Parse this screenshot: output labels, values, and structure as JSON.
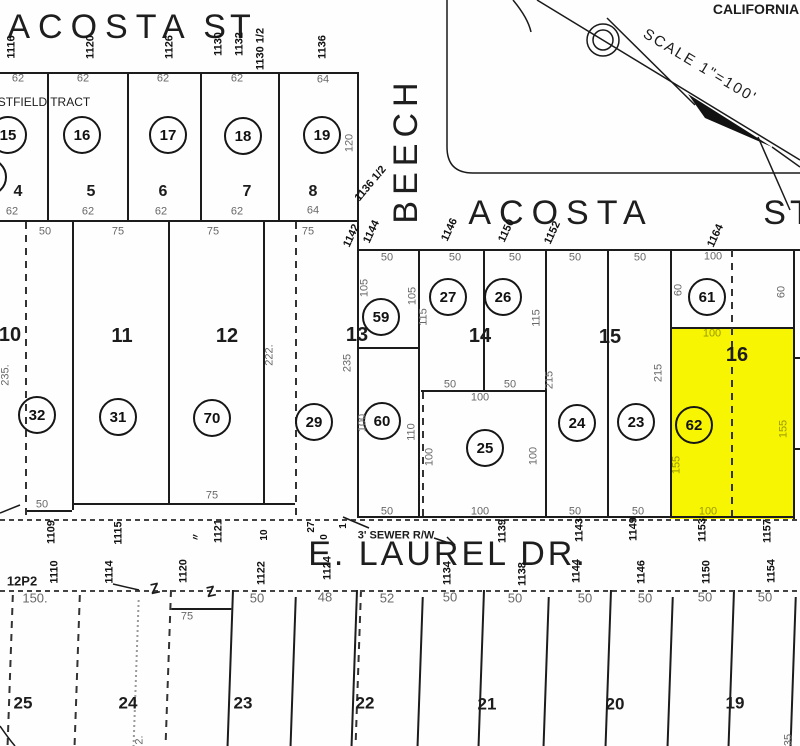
{
  "map": {
    "region_text": "CALIFORNIA",
    "scale_label": "SCALE 1\"=100'",
    "tract_label": "STFIELD TRACT",
    "streets": [
      "ACOSTA ST",
      "BEECH",
      "ACOSTA ST",
      "E. LAUREL DR."
    ],
    "sewer_note": "3' SEWER R/W",
    "sheet_ref": "12P2",
    "highlight": {
      "parcel": "62",
      "block": "16",
      "color": "#f7f501",
      "dim_color": "#9a9a00"
    }
  },
  "labels": {
    "streets": [
      {
        "t": "ACOSTA",
        "x": 100,
        "y": 27,
        "ls": 8
      },
      {
        "t": "ST",
        "x": 229,
        "y": 27,
        "ls": 4
      },
      {
        "t": "BEECH",
        "x": 406,
        "y": 150,
        "ls": 6,
        "r": -90
      },
      {
        "t": "ACOSTA",
        "x": 561,
        "y": 213,
        "ls": 8
      },
      {
        "t": "ST",
        "x": 789,
        "y": 213,
        "ls": 4
      },
      {
        "t": "E. LAUREL DR.",
        "x": 448,
        "y": 554,
        "ls": 3
      }
    ],
    "annotations": [
      {
        "t": "CALIFORNIA",
        "x": 756,
        "y": 9,
        "s": 14,
        "w": 700
      },
      {
        "t": "SCALE 1\"=100'",
        "x": 700,
        "y": 66,
        "s": 15,
        "r": 31,
        "ls": 2
      },
      {
        "t": "STFIELD TRACT",
        "x": 44,
        "y": 102,
        "s": 12
      },
      {
        "t": "3' SEWER R/W",
        "x": 396,
        "y": 536,
        "s": 11,
        "w": 700
      },
      {
        "t": "12P2",
        "x": 22,
        "y": 581,
        "s": 13,
        "w": 700
      },
      {
        "t": "Z",
        "x": 155,
        "y": 589,
        "s": 15,
        "w": 700,
        "r": -12
      },
      {
        "t": "Z",
        "x": 211,
        "y": 592,
        "s": 15,
        "w": 700,
        "r": -12
      }
    ],
    "addresses": [
      {
        "t": "1116",
        "x": 12,
        "y": 47,
        "r": -90
      },
      {
        "t": "1120",
        "x": 91,
        "y": 47,
        "r": -90
      },
      {
        "t": "1126",
        "x": 170,
        "y": 47,
        "r": -90
      },
      {
        "t": "1130",
        "x": 219,
        "y": 44,
        "r": -90
      },
      {
        "t": "1132",
        "x": 240,
        "y": 44,
        "r": -90
      },
      {
        "t": "1130 1/2",
        "x": 261,
        "y": 49,
        "r": -90
      },
      {
        "t": "1136",
        "x": 323,
        "y": 47,
        "r": -90
      },
      {
        "t": "1136 1/2",
        "x": 371,
        "y": 184,
        "r": -50
      },
      {
        "t": "1142",
        "x": 352,
        "y": 236,
        "r": -65
      },
      {
        "t": "1144",
        "x": 372,
        "y": 232,
        "r": -65
      },
      {
        "t": "1146",
        "x": 450,
        "y": 230,
        "r": -65
      },
      {
        "t": "1150",
        "x": 507,
        "y": 231,
        "r": -65
      },
      {
        "t": "1152",
        "x": 553,
        "y": 233,
        "r": -65
      },
      {
        "t": "1164",
        "x": 716,
        "y": 236,
        "r": -65
      },
      {
        "t": "1109",
        "x": 52,
        "y": 532,
        "r": -90
      },
      {
        "t": "1115",
        "x": 119,
        "y": 533,
        "r": -90
      },
      {
        "t": "〃",
        "x": 196,
        "y": 537,
        "r": -90,
        "s": 9
      },
      {
        "t": "1121",
        "x": 219,
        "y": 531,
        "r": -90
      },
      {
        "t": "10",
        "x": 265,
        "y": 535,
        "r": -90,
        "s": 10
      },
      {
        "t": "27",
        "x": 312,
        "y": 527,
        "r": -90,
        "s": 10
      },
      {
        "t": "0",
        "x": 325,
        "y": 537,
        "r": -90,
        "s": 10
      },
      {
        "t": "1",
        "x": 344,
        "y": 526,
        "r": -90,
        "s": 10
      },
      {
        "t": "1139",
        "x": 503,
        "y": 531,
        "r": -90
      },
      {
        "t": "1143",
        "x": 580,
        "y": 530,
        "r": -90
      },
      {
        "t": "1149",
        "x": 634,
        "y": 529,
        "r": -90
      },
      {
        "t": "1153",
        "x": 703,
        "y": 530,
        "r": -90
      },
      {
        "t": "1157",
        "x": 768,
        "y": 531,
        "r": -90
      },
      {
        "t": "1110",
        "x": 55,
        "y": 572,
        "r": -90
      },
      {
        "t": "1114",
        "x": 110,
        "y": 572,
        "r": -90
      },
      {
        "t": "1120",
        "x": 184,
        "y": 571,
        "r": -90
      },
      {
        "t": "1122",
        "x": 262,
        "y": 573,
        "r": -90
      },
      {
        "t": "1124",
        "x": 328,
        "y": 568,
        "r": -90
      },
      {
        "t": "1134",
        "x": 448,
        "y": 573,
        "r": -90
      },
      {
        "t": "1138",
        "x": 523,
        "y": 574,
        "r": -90
      },
      {
        "t": "1144",
        "x": 577,
        "y": 571,
        "r": -90
      },
      {
        "t": "1146",
        "x": 642,
        "y": 572,
        "r": -90
      },
      {
        "t": "1150",
        "x": 707,
        "y": 572,
        "r": -90
      },
      {
        "t": "1154",
        "x": 772,
        "y": 571,
        "r": -90
      }
    ],
    "dimensions": [
      {
        "t": "62",
        "x": 18,
        "y": 79
      },
      {
        "t": "62",
        "x": 83,
        "y": 79
      },
      {
        "t": "62",
        "x": 163,
        "y": 79
      },
      {
        "t": "62",
        "x": 237,
        "y": 79
      },
      {
        "t": "64",
        "x": 323,
        "y": 80
      },
      {
        "t": "62",
        "x": 12,
        "y": 212
      },
      {
        "t": "62",
        "x": 88,
        "y": 212
      },
      {
        "t": "62",
        "x": 161,
        "y": 212
      },
      {
        "t": "62",
        "x": 237,
        "y": 212
      },
      {
        "t": "64",
        "x": 313,
        "y": 211
      },
      {
        "t": "50",
        "x": 45,
        "y": 232
      },
      {
        "t": "75",
        "x": 118,
        "y": 232
      },
      {
        "t": "75",
        "x": 213,
        "y": 232
      },
      {
        "t": "75",
        "x": 308,
        "y": 232
      },
      {
        "t": "50",
        "x": 387,
        "y": 258
      },
      {
        "t": "50",
        "x": 455,
        "y": 258
      },
      {
        "t": "50",
        "x": 515,
        "y": 258
      },
      {
        "t": "50",
        "x": 575,
        "y": 258
      },
      {
        "t": "50",
        "x": 640,
        "y": 258
      },
      {
        "t": "100",
        "x": 713,
        "y": 257
      },
      {
        "t": "120",
        "x": 350,
        "y": 143,
        "r": -90
      },
      {
        "t": "235.",
        "x": 6,
        "y": 375,
        "r": -90
      },
      {
        "t": "222.",
        "x": 270,
        "y": 355,
        "r": -90
      },
      {
        "t": "235",
        "x": 348,
        "y": 363,
        "r": -90
      },
      {
        "t": "105",
        "x": 365,
        "y": 288,
        "r": -90
      },
      {
        "t": "105",
        "x": 413,
        "y": 296,
        "r": -90
      },
      {
        "t": "115",
        "x": 424,
        "y": 317,
        "r": -90
      },
      {
        "t": "115",
        "x": 537,
        "y": 318,
        "r": -90
      },
      {
        "t": "215",
        "x": 550,
        "y": 380,
        "r": -90
      },
      {
        "t": "215",
        "x": 659,
        "y": 373,
        "r": -90
      },
      {
        "t": "100",
        "x": 363,
        "y": 423,
        "r": -90
      },
      {
        "t": "110",
        "x": 412,
        "y": 432,
        "r": -90
      },
      {
        "t": "100",
        "x": 430,
        "y": 457,
        "r": -90
      },
      {
        "t": "100",
        "x": 534,
        "y": 456,
        "r": -90
      },
      {
        "t": "60",
        "x": 679,
        "y": 290,
        "r": -90
      },
      {
        "t": "60",
        "x": 782,
        "y": 292,
        "r": -90
      },
      {
        "t": "50",
        "x": 450,
        "y": 385
      },
      {
        "t": "50",
        "x": 510,
        "y": 385
      },
      {
        "t": "100",
        "x": 480,
        "y": 398
      },
      {
        "t": "75",
        "x": 212,
        "y": 496
      },
      {
        "t": "50",
        "x": 42,
        "y": 505
      },
      {
        "t": "50",
        "x": 387,
        "y": 512
      },
      {
        "t": "100",
        "x": 480,
        "y": 512
      },
      {
        "t": "50",
        "x": 575,
        "y": 512
      },
      {
        "t": "50",
        "x": 638,
        "y": 512
      },
      {
        "t": "150.",
        "x": 35,
        "y": 598,
        "s": 13
      },
      {
        "t": "50",
        "x": 257,
        "y": 598,
        "s": 13
      },
      {
        "t": "48",
        "x": 325,
        "y": 597,
        "s": 13
      },
      {
        "t": "52",
        "x": 387,
        "y": 598,
        "s": 13
      },
      {
        "t": "50",
        "x": 450,
        "y": 597,
        "s": 13
      },
      {
        "t": "50",
        "x": 515,
        "y": 598,
        "s": 13
      },
      {
        "t": "50",
        "x": 585,
        "y": 598,
        "s": 13
      },
      {
        "t": "50",
        "x": 645,
        "y": 598,
        "s": 13
      },
      {
        "t": "50",
        "x": 705,
        "y": 597,
        "s": 13
      },
      {
        "t": "50",
        "x": 765,
        "y": 597,
        "s": 13
      },
      {
        "t": "75",
        "x": 187,
        "y": 617
      },
      {
        "t": "2.",
        "x": 140,
        "y": 740,
        "r": -90
      },
      {
        "t": "35",
        "x": 789,
        "y": 740,
        "r": -90
      },
      {
        "t": "100",
        "x": 712,
        "y": 334,
        "c": "#9a9a00"
      },
      {
        "t": "155",
        "x": 677,
        "y": 465,
        "r": -90,
        "c": "#9a9a00"
      },
      {
        "t": "155",
        "x": 784,
        "y": 429,
        "r": -90,
        "c": "#9a9a00"
      },
      {
        "t": "100",
        "x": 708,
        "y": 512,
        "c": "#9a9a00"
      }
    ],
    "lots": [
      {
        "t": "4",
        "x": 18,
        "y": 192
      },
      {
        "t": "5",
        "x": 91,
        "y": 192
      },
      {
        "t": "6",
        "x": 163,
        "y": 192
      },
      {
        "t": "7",
        "x": 247,
        "y": 192
      },
      {
        "t": "8",
        "x": 313,
        "y": 192
      }
    ],
    "blocks": [
      {
        "t": "10",
        "x": 10,
        "y": 335
      },
      {
        "t": "11",
        "x": 122,
        "y": 336
      },
      {
        "t": "12",
        "x": 227,
        "y": 336
      },
      {
        "t": "13",
        "x": 357,
        "y": 335
      },
      {
        "t": "14",
        "x": 480,
        "y": 336
      },
      {
        "t": "15",
        "x": 610,
        "y": 337
      },
      {
        "t": "16",
        "x": 737,
        "y": 355
      },
      {
        "t": "25",
        "x": 23,
        "y": 703,
        "s": 17
      },
      {
        "t": "24",
        "x": 128,
        "y": 703,
        "s": 17
      },
      {
        "t": "23",
        "x": 243,
        "y": 703,
        "s": 17
      },
      {
        "t": "22",
        "x": 365,
        "y": 703,
        "s": 17
      },
      {
        "t": "21",
        "x": 487,
        "y": 704,
        "s": 17
      },
      {
        "t": "20",
        "x": 615,
        "y": 704,
        "s": 17
      },
      {
        "t": "19",
        "x": 735,
        "y": 703,
        "s": 17
      }
    ],
    "circles": [
      {
        "t": "",
        "x": -12,
        "y": 177
      },
      {
        "t": "15",
        "x": 8,
        "y": 135
      },
      {
        "t": "16",
        "x": 82,
        "y": 135
      },
      {
        "t": "17",
        "x": 168,
        "y": 135
      },
      {
        "t": "18",
        "x": 243,
        "y": 136
      },
      {
        "t": "19",
        "x": 322,
        "y": 135
      },
      {
        "t": "59",
        "x": 381,
        "y": 317
      },
      {
        "t": "27",
        "x": 448,
        "y": 297
      },
      {
        "t": "26",
        "x": 503,
        "y": 297
      },
      {
        "t": "61",
        "x": 707,
        "y": 297
      },
      {
        "t": "32",
        "x": 37,
        "y": 415
      },
      {
        "t": "31",
        "x": 118,
        "y": 417
      },
      {
        "t": "70",
        "x": 212,
        "y": 418
      },
      {
        "t": "29",
        "x": 314,
        "y": 422
      },
      {
        "t": "60",
        "x": 382,
        "y": 421
      },
      {
        "t": "25",
        "x": 485,
        "y": 448
      },
      {
        "t": "24",
        "x": 577,
        "y": 423
      },
      {
        "t": "23",
        "x": 636,
        "y": 422
      },
      {
        "t": "62",
        "x": 694,
        "y": 425
      }
    ]
  }
}
